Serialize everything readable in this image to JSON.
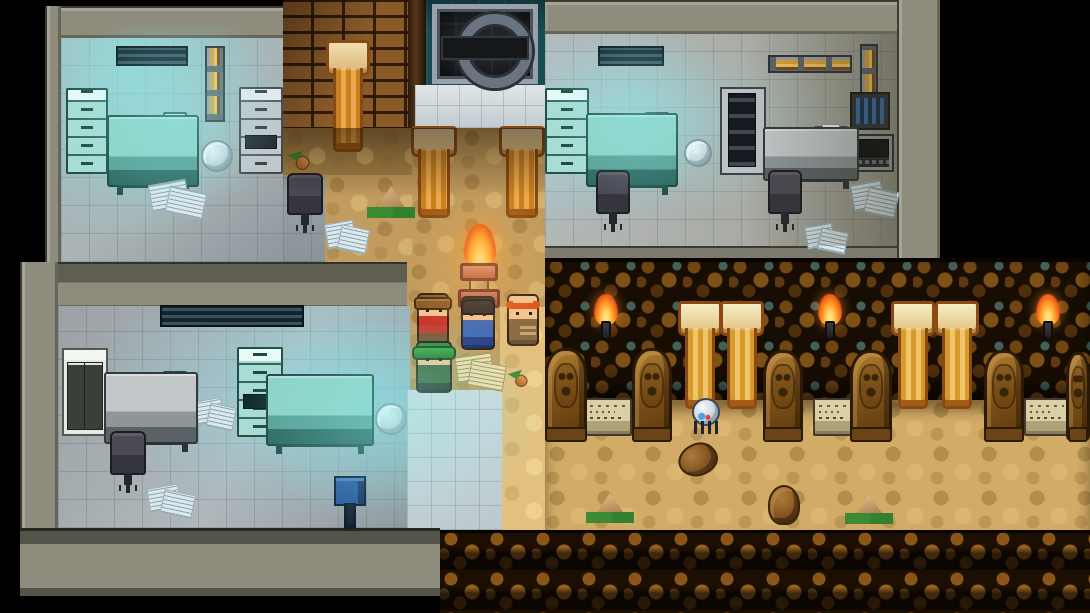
{
  "meta": {
    "scene": "pixel-rpg-lab-and-tomb",
    "viewport": {
      "width": 1090,
      "height": 613
    }
  },
  "palette": {
    "background": "#000000",
    "wall": "#8d8c7d",
    "tile_floor": "#aab3b5",
    "glow_cyan": "#8cebeb",
    "sand": "#c29c5e",
    "sand_lit": "#e4c07e",
    "brick": "#8a5a28",
    "vault_wall": "#184b52",
    "tomb_cobble": "#6e4513",
    "pillar_gold": "#eaa94e",
    "flame_orange": "#ffab2e",
    "furniture_teal": "#8fd2c6",
    "furniture_gray": "#c2c8ca",
    "screen_blue": "#143a74",
    "statue_brown": "#7b4e16",
    "plaque_stone": "#d9d0a8"
  },
  "regions": [
    {
      "type": "wall",
      "name": "wall-top-left-room-top",
      "x": 45,
      "y": 6,
      "w": 238,
      "h": 32,
      "interactable": false
    },
    {
      "type": "wall-side",
      "name": "wall-top-left-room-side",
      "x": 45,
      "y": 6,
      "w": 16,
      "h": 256,
      "interactable": false
    },
    {
      "type": "tiles-tl",
      "name": "floor-lab-top-left",
      "x": 61,
      "y": 38,
      "w": 222,
      "h": 224,
      "interactable": false
    },
    {
      "type": "tiles-dim",
      "name": "floor-lab-top-left-ext",
      "x": 283,
      "y": 172,
      "w": 42,
      "h": 90,
      "interactable": false
    },
    {
      "type": "bricks",
      "name": "brick-wall",
      "x": 283,
      "y": 0,
      "w": 125,
      "h": 130,
      "interactable": false
    },
    {
      "type": "pilaster",
      "name": "door-pilaster",
      "x": 408,
      "y": 0,
      "w": 18,
      "h": 128,
      "interactable": false
    },
    {
      "type": "tealwall",
      "name": "vault-wall",
      "x": 426,
      "y": 0,
      "w": 119,
      "h": 88,
      "interactable": false
    },
    {
      "type": "tiles-bright",
      "name": "floor-gate-landing",
      "x": 415,
      "y": 85,
      "w": 130,
      "h": 43,
      "interactable": false
    },
    {
      "type": "sand-dark",
      "name": "sand-path-upper",
      "x": 283,
      "y": 128,
      "w": 129,
      "h": 47,
      "interactable": false
    },
    {
      "type": "sand",
      "name": "sand-path-left",
      "x": 325,
      "y": 175,
      "w": 87,
      "h": 87,
      "interactable": false
    },
    {
      "type": "sand",
      "name": "sand-path-main",
      "x": 412,
      "y": 128,
      "w": 133,
      "h": 134,
      "interactable": false
    },
    {
      "type": "sand",
      "name": "sand-path-mid",
      "x": 407,
      "y": 262,
      "w": 138,
      "h": 45,
      "interactable": false
    },
    {
      "type": "sand",
      "name": "sand-path-lower",
      "x": 407,
      "y": 307,
      "w": 93,
      "h": 83,
      "interactable": false
    },
    {
      "type": "sand-lit",
      "name": "sand-path-lit-strip",
      "x": 500,
      "y": 307,
      "w": 45,
      "h": 223,
      "interactable": false
    },
    {
      "type": "wall-mid",
      "name": "wall-divider-left-rooms",
      "x": 20,
      "y": 262,
      "w": 387,
      "h": 46,
      "interactable": false
    },
    {
      "type": "wall-side",
      "name": "wall-bottom-left-room-side",
      "x": 20,
      "y": 262,
      "w": 38,
      "h": 334,
      "interactable": false
    },
    {
      "type": "tiles-bl",
      "name": "floor-lab-bottom-left",
      "x": 58,
      "y": 306,
      "w": 352,
      "h": 222,
      "interactable": false
    },
    {
      "type": "tiles-lit",
      "name": "floor-passage-to-tomb",
      "x": 407,
      "y": 390,
      "w": 95,
      "h": 140,
      "interactable": false
    },
    {
      "type": "wall-bottom",
      "name": "wall-bottom-left-room-bottom",
      "x": 20,
      "y": 528,
      "w": 420,
      "h": 68,
      "interactable": false
    },
    {
      "type": "wall",
      "name": "wall-top-right-room-top",
      "x": 545,
      "y": 0,
      "w": 395,
      "h": 34,
      "interactable": false
    },
    {
      "type": "tiles-tr",
      "name": "floor-lab-top-right",
      "x": 545,
      "y": 34,
      "w": 352,
      "h": 214,
      "interactable": false
    },
    {
      "type": "wall-side",
      "name": "wall-top-right-room-side",
      "x": 897,
      "y": 0,
      "w": 43,
      "h": 262,
      "interactable": false
    },
    {
      "type": "wall-thin",
      "name": "wall-top-right-room-bottom",
      "x": 545,
      "y": 246,
      "w": 352,
      "h": 14,
      "interactable": false
    },
    {
      "type": "cobble",
      "name": "tomb-wall",
      "x": 545,
      "y": 258,
      "w": 545,
      "h": 142,
      "interactable": false
    },
    {
      "type": "sand-tomb",
      "name": "tomb-floor",
      "x": 545,
      "y": 400,
      "w": 545,
      "h": 130,
      "interactable": false
    },
    {
      "type": "ledge",
      "name": "tomb-ledge",
      "x": 440,
      "y": 530,
      "w": 650,
      "h": 83,
      "interactable": false
    }
  ],
  "entities": [
    {
      "type": "vent",
      "name": "wall-vent",
      "x": 116,
      "y": 46,
      "w": 72,
      "h": 20,
      "interactable": false
    },
    {
      "type": "pipe-v",
      "name": "cable-conduit",
      "x": 205,
      "y": 46,
      "w": 20,
      "h": 76,
      "interactable": false
    },
    {
      "type": "cabinet-teal",
      "name": "filing-cabinet",
      "x": 66,
      "y": 88,
      "w": 42,
      "h": 86,
      "interactable": true
    },
    {
      "type": "desk-teal",
      "name": "computer-desk",
      "x": 107,
      "y": 115,
      "w": 92,
      "h": 72,
      "interactable": false
    },
    {
      "type": "monitor-blue",
      "name": "computer-monitor",
      "x": 116,
      "y": 118,
      "w": 36,
      "h": 40,
      "interactable": true
    },
    {
      "type": "server",
      "name": "server-tower",
      "x": 163,
      "y": 112,
      "w": 24,
      "h": 46,
      "interactable": false
    },
    {
      "type": "keyboard",
      "name": "keyboard",
      "x": 112,
      "y": 160,
      "w": 40,
      "h": 11,
      "interactable": false
    },
    {
      "type": "trash",
      "name": "paper-ball",
      "x": 201,
      "y": 140,
      "w": 32,
      "h": 32,
      "interactable": false
    },
    {
      "type": "cabinet-gray",
      "name": "filing-cabinet",
      "x": 239,
      "y": 87,
      "w": 44,
      "h": 87,
      "interactable": true
    },
    {
      "type": "papers",
      "name": "scattered-papers",
      "x": 150,
      "y": 176,
      "w": 58,
      "h": 42,
      "interactable": false
    },
    {
      "type": "chair",
      "name": "office-chair",
      "x": 287,
      "y": 173,
      "w": 36,
      "h": 42,
      "interactable": true
    },
    {
      "type": "plant-s",
      "name": "small-plant",
      "x": 288,
      "y": 152,
      "w": 26,
      "h": 20,
      "interactable": false
    },
    {
      "type": "pillar",
      "name": "stone-pillar",
      "x": 329,
      "y": 40,
      "w": 38,
      "h": 112,
      "interactable": false
    },
    {
      "type": "gate",
      "name": "metal-gate",
      "x": 432,
      "y": 4,
      "w": 106,
      "h": 80,
      "interactable": true
    },
    {
      "type": "pillar",
      "name": "stone-pillar",
      "x": 414,
      "y": 126,
      "w": 40,
      "h": 92,
      "interactable": false
    },
    {
      "type": "pillar",
      "name": "stone-pillar",
      "x": 502,
      "y": 126,
      "w": 40,
      "h": 92,
      "interactable": false
    },
    {
      "type": "plant-tent",
      "name": "desert-plant",
      "x": 371,
      "y": 186,
      "w": 40,
      "h": 32,
      "interactable": false
    },
    {
      "type": "papers",
      "name": "scattered-papers",
      "x": 326,
      "y": 216,
      "w": 44,
      "h": 38,
      "interactable": false
    },
    {
      "type": "flame",
      "name": "brazier-flame",
      "x": 464,
      "y": 224,
      "w": 32,
      "h": 48,
      "interactable": false
    },
    {
      "type": "pedestal",
      "name": "torch-brazier",
      "x": 460,
      "y": 270,
      "w": 38,
      "h": 34,
      "interactable": false
    },
    {
      "type": "char-red",
      "name": "character-red-shirt",
      "x": 417,
      "y": 293,
      "w": 32,
      "h": 52,
      "interactable": true
    },
    {
      "type": "char-green",
      "name": "character-green-hat",
      "x": 416,
      "y": 341,
      "w": 36,
      "h": 52,
      "interactable": true
    },
    {
      "type": "char-blue",
      "name": "character-blue-vest",
      "x": 461,
      "y": 296,
      "w": 34,
      "h": 54,
      "interactable": true
    },
    {
      "type": "char-monk",
      "name": "character-monk",
      "x": 507,
      "y": 294,
      "w": 32,
      "h": 52,
      "interactable": true
    },
    {
      "type": "papers-gold",
      "name": "dropped-papers",
      "x": 456,
      "y": 350,
      "w": 50,
      "h": 40,
      "interactable": false
    },
    {
      "type": "plant-s",
      "name": "small-plant",
      "x": 508,
      "y": 371,
      "w": 24,
      "h": 18,
      "interactable": false
    },
    {
      "type": "vent",
      "name": "wall-vent",
      "x": 598,
      "y": 46,
      "w": 66,
      "h": 20,
      "interactable": false
    },
    {
      "type": "pipe-h",
      "name": "wall-pipe",
      "x": 768,
      "y": 55,
      "w": 84,
      "h": 18,
      "interactable": false
    },
    {
      "type": "pipe-v",
      "name": "cable-conduit",
      "x": 860,
      "y": 44,
      "w": 18,
      "h": 56,
      "interactable": false
    },
    {
      "type": "device-wall",
      "name": "wall-device",
      "x": 850,
      "y": 92,
      "w": 40,
      "h": 38,
      "interactable": false
    },
    {
      "type": "cabinet-teal",
      "name": "filing-cabinet",
      "x": 545,
      "y": 88,
      "w": 44,
      "h": 86,
      "interactable": true
    },
    {
      "type": "desk-teal",
      "name": "computer-desk",
      "x": 586,
      "y": 113,
      "w": 92,
      "h": 74,
      "interactable": false
    },
    {
      "type": "monitor-blue",
      "name": "computer-monitor",
      "x": 596,
      "y": 118,
      "w": 36,
      "h": 40,
      "interactable": true
    },
    {
      "type": "server",
      "name": "server-tower",
      "x": 645,
      "y": 112,
      "w": 24,
      "h": 46,
      "interactable": false
    },
    {
      "type": "keyboard",
      "name": "keyboard",
      "x": 592,
      "y": 160,
      "w": 40,
      "h": 11,
      "interactable": false
    },
    {
      "type": "chair",
      "name": "office-chair",
      "x": 596,
      "y": 170,
      "w": 34,
      "h": 44,
      "interactable": true
    },
    {
      "type": "trash",
      "name": "paper-ball",
      "x": 684,
      "y": 139,
      "w": 28,
      "h": 28,
      "interactable": false
    },
    {
      "type": "cabinet-door",
      "name": "storage-cabinet",
      "x": 720,
      "y": 87,
      "w": 46,
      "h": 88,
      "interactable": true
    },
    {
      "type": "desk-gray",
      "name": "side-desk",
      "x": 763,
      "y": 127,
      "w": 96,
      "h": 54,
      "interactable": false
    },
    {
      "type": "papers",
      "name": "desk-papers",
      "x": 768,
      "y": 126,
      "w": 44,
      "h": 38,
      "interactable": false
    },
    {
      "type": "printer",
      "name": "printer",
      "x": 814,
      "y": 126,
      "w": 34,
      "h": 30,
      "interactable": true
    },
    {
      "type": "terminal",
      "name": "control-terminal",
      "x": 850,
      "y": 134,
      "w": 44,
      "h": 38,
      "interactable": true
    },
    {
      "type": "chair",
      "name": "office-chair",
      "x": 768,
      "y": 170,
      "w": 34,
      "h": 44,
      "interactable": true
    },
    {
      "type": "papers",
      "name": "scattered-papers",
      "x": 852,
      "y": 176,
      "w": 46,
      "h": 42,
      "interactable": false
    },
    {
      "type": "papers",
      "name": "scattered-papers",
      "x": 806,
      "y": 220,
      "w": 42,
      "h": 34,
      "interactable": false
    },
    {
      "type": "vent",
      "name": "wall-vent",
      "x": 160,
      "y": 305,
      "w": 144,
      "h": 22,
      "interactable": false
    },
    {
      "type": "cabinet-open",
      "name": "open-cabinet",
      "x": 62,
      "y": 348,
      "w": 46,
      "h": 88,
      "interactable": true
    },
    {
      "type": "desk-gray",
      "name": "computer-desk",
      "x": 104,
      "y": 372,
      "w": 94,
      "h": 72,
      "interactable": false
    },
    {
      "type": "monitor-dark",
      "name": "computer-monitor",
      "x": 113,
      "y": 376,
      "w": 36,
      "h": 38,
      "interactable": true
    },
    {
      "type": "server",
      "name": "server-tower",
      "x": 163,
      "y": 371,
      "w": 24,
      "h": 46,
      "interactable": false
    },
    {
      "type": "keyboard",
      "name": "keyboard",
      "x": 108,
      "y": 418,
      "w": 42,
      "h": 11,
      "interactable": false
    },
    {
      "type": "chair",
      "name": "office-chair",
      "x": 110,
      "y": 431,
      "w": 36,
      "h": 44,
      "interactable": true
    },
    {
      "type": "cabinet-teal2",
      "name": "filing-cabinet",
      "x": 237,
      "y": 347,
      "w": 46,
      "h": 90,
      "interactable": true
    },
    {
      "type": "desk-teal",
      "name": "computer-desk",
      "x": 266,
      "y": 374,
      "w": 108,
      "h": 72,
      "interactable": false
    },
    {
      "type": "monitor-blue",
      "name": "computer-monitor",
      "x": 284,
      "y": 377,
      "w": 34,
      "h": 38,
      "interactable": true
    },
    {
      "type": "printer",
      "name": "printer",
      "x": 324,
      "y": 390,
      "w": 44,
      "h": 36,
      "interactable": true
    },
    {
      "type": "trash",
      "name": "paper-ball",
      "x": 375,
      "y": 403,
      "w": 32,
      "h": 32,
      "interactable": false
    },
    {
      "type": "papers",
      "name": "scattered-papers",
      "x": 196,
      "y": 394,
      "w": 40,
      "h": 36,
      "interactable": false
    },
    {
      "type": "papers",
      "name": "scattered-papers",
      "x": 148,
      "y": 481,
      "w": 48,
      "h": 36,
      "interactable": false
    },
    {
      "type": "device-floor",
      "name": "scanner-device",
      "x": 334,
      "y": 476,
      "w": 32,
      "h": 48,
      "interactable": true
    },
    {
      "type": "torch",
      "name": "wall-torch",
      "x": 592,
      "y": 304,
      "w": 28,
      "h": 36,
      "interactable": false
    },
    {
      "type": "torch",
      "name": "wall-torch",
      "x": 816,
      "y": 304,
      "w": 28,
      "h": 36,
      "interactable": false
    },
    {
      "type": "torch",
      "name": "wall-torch",
      "x": 1034,
      "y": 304,
      "w": 28,
      "h": 36,
      "interactable": false
    },
    {
      "type": "pillar-t",
      "name": "tomb-pillar",
      "x": 681,
      "y": 301,
      "w": 38,
      "h": 108,
      "interactable": false
    },
    {
      "type": "pillar-t",
      "name": "tomb-pillar",
      "x": 723,
      "y": 301,
      "w": 38,
      "h": 108,
      "interactable": false
    },
    {
      "type": "pillar-t",
      "name": "tomb-pillar",
      "x": 894,
      "y": 301,
      "w": 38,
      "h": 108,
      "interactable": false
    },
    {
      "type": "pillar-t",
      "name": "tomb-pillar",
      "x": 938,
      "y": 301,
      "w": 38,
      "h": 108,
      "interactable": false
    },
    {
      "type": "statue",
      "name": "carved-statue",
      "x": 545,
      "y": 348,
      "w": 42,
      "h": 92,
      "interactable": false
    },
    {
      "type": "statue",
      "name": "carved-statue",
      "x": 632,
      "y": 348,
      "w": 40,
      "h": 92,
      "interactable": false
    },
    {
      "type": "statue",
      "name": "carved-statue",
      "x": 763,
      "y": 350,
      "w": 40,
      "h": 90,
      "interactable": false
    },
    {
      "type": "statue",
      "name": "carved-statue",
      "x": 850,
      "y": 350,
      "w": 42,
      "h": 90,
      "interactable": false
    },
    {
      "type": "statue",
      "name": "carved-statue",
      "x": 984,
      "y": 350,
      "w": 40,
      "h": 90,
      "interactable": false
    },
    {
      "type": "statue",
      "name": "carved-statue",
      "x": 1066,
      "y": 352,
      "w": 24,
      "h": 88,
      "interactable": false
    },
    {
      "type": "plaque",
      "name": "stone-plaque",
      "x": 584,
      "y": 398,
      "w": 48,
      "h": 38,
      "interactable": true
    },
    {
      "type": "plaque",
      "name": "stone-plaque",
      "x": 813,
      "y": 398,
      "w": 42,
      "h": 38,
      "interactable": true
    },
    {
      "type": "plaque",
      "name": "stone-plaque",
      "x": 1024,
      "y": 398,
      "w": 46,
      "h": 38,
      "interactable": true
    },
    {
      "type": "creature",
      "name": "spider-critter",
      "x": 690,
      "y": 398,
      "w": 32,
      "h": 38,
      "interactable": true
    },
    {
      "type": "rock",
      "name": "stone-debris",
      "x": 678,
      "y": 443,
      "w": 40,
      "h": 33,
      "interactable": false
    },
    {
      "type": "rock-head",
      "name": "stone-head",
      "x": 768,
      "y": 485,
      "w": 32,
      "h": 40,
      "interactable": false
    },
    {
      "type": "plant-tent",
      "name": "desert-plant",
      "x": 590,
      "y": 493,
      "w": 40,
      "h": 30,
      "interactable": false
    },
    {
      "type": "plant-tent",
      "name": "desert-plant",
      "x": 849,
      "y": 494,
      "w": 40,
      "h": 30,
      "interactable": false
    }
  ],
  "overlays": [
    {
      "type": "glow",
      "name": "lab-light-glow",
      "x": 55,
      "y": 25,
      "w": 240,
      "h": 190,
      "interactable": false
    },
    {
      "type": "glow",
      "name": "lab-light-glow",
      "x": 245,
      "y": 325,
      "w": 305,
      "h": 205,
      "interactable": false
    },
    {
      "type": "glow",
      "name": "lab-light-glow",
      "x": 545,
      "y": 34,
      "w": 185,
      "h": 165,
      "interactable": false
    },
    {
      "type": "glow-warm",
      "name": "brazier-glow",
      "x": 408,
      "y": 192,
      "w": 145,
      "h": 150,
      "interactable": false
    },
    {
      "type": "shade-top",
      "name": "sand-shadow",
      "x": 283,
      "y": 128,
      "w": 262,
      "h": 70,
      "interactable": false
    },
    {
      "type": "shade-right",
      "name": "room-shadow",
      "x": 745,
      "y": 34,
      "w": 152,
      "h": 212,
      "interactable": false
    }
  ]
}
